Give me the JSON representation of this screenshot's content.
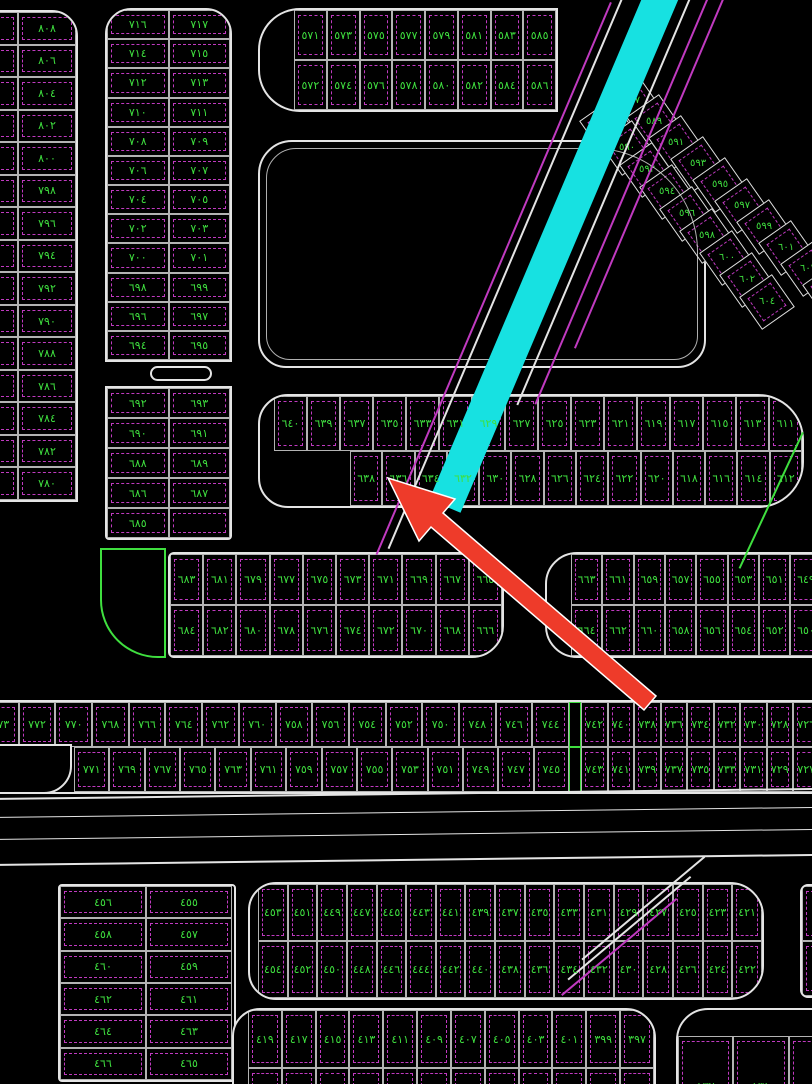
{
  "canvas": {
    "width": 812,
    "height": 1084,
    "background": "#000000"
  },
  "colors": {
    "background": "#000000",
    "road_line_white": "#e4e4e4",
    "plot_dash_magenta": "#c03ac0",
    "number_green": "#3fdf3f",
    "road_cyan": "#17e1e1",
    "arrow_red": "#ee3b2a"
  },
  "labels": {
    "future_text": "مستقبلى"
  },
  "annotation": {
    "type": "red-arrow",
    "points": "388,478 455,499 443,513 656,696 644,710 431,527 419,541",
    "fill": "#ee3b2a",
    "stroke": "#ffffff"
  },
  "diagonal_block": {
    "numbers": [
      "٥٨٧",
      "٥٨٨",
      "٥٨٩",
      "٥٩٠",
      "٥٩١",
      "٥٩٢",
      "٥٩٣",
      "٥٩٤",
      "٥٩٥",
      "٥٩٦",
      "٥٩٧",
      "٥٩٨",
      "٥٩٩",
      "٦٠٠",
      "٦٠١",
      "٦٠٢",
      "٦٠٣",
      "٦٠٤",
      "٦٠٦"
    ],
    "upper_start": [
      632,
      101
    ],
    "upper_step": [
      22,
      21
    ],
    "lower_start": [
      607,
      126
    ],
    "lower_step": [
      20,
      22
    ],
    "rotate": 55,
    "cell": 40
  },
  "blocks": [
    {
      "name": "block-top-left-outer",
      "x": -40,
      "y": 10,
      "w": 118,
      "h": 492,
      "radius": "0 26px 0 0",
      "colWidths": [
        56,
        58
      ],
      "rows": [
        {
          "cells": [
            "٨٠٩",
            "٨٠٨"
          ]
        },
        {
          "cells": [
            "٨٠٧",
            "٨٠٦"
          ]
        },
        {
          "cells": [
            "٨٠٥",
            "٨٠٤"
          ]
        },
        {
          "cells": [
            "٨٠٣",
            "٨٠٢"
          ]
        },
        {
          "cells": [
            "٨٠١",
            "٨٠٠"
          ]
        },
        {
          "cells": [
            "٧٩٩",
            "٧٩٨"
          ]
        },
        {
          "cells": [
            "٧٩٧",
            "٧٩٦"
          ]
        },
        {
          "cells": [
            "٧٩٥",
            "٧٩٤"
          ]
        },
        {
          "cells": [
            "٧٩٣",
            "٧٩٢"
          ]
        },
        {
          "cells": [
            "٧٩١",
            "٧٩٠"
          ]
        },
        {
          "cells": [
            "٧٨٩",
            "٧٨٨"
          ]
        },
        {
          "cells": [
            "٧٨٧",
            "٧٨٦"
          ]
        },
        {
          "cells": [
            "٧٨٥",
            "٧٨٤"
          ]
        },
        {
          "cells": [
            "٧٨٣",
            "٧٨٢"
          ]
        },
        {
          "cells": [
            "٧٨١",
            "٧٨٠"
          ]
        }
      ]
    },
    {
      "name": "block-left-inner-upper",
      "x": 105,
      "y": 8,
      "w": 127,
      "h": 354,
      "radius": "26px 26px 0 0",
      "rows": [
        {
          "cells": [
            "٧١٦",
            "٧١٧"
          ]
        },
        {
          "cells": [
            "٧١٤",
            "٧١٥"
          ]
        },
        {
          "cells": [
            "٧١٢",
            "٧١٣"
          ]
        },
        {
          "cells": [
            "٧١٠",
            "٧١١"
          ]
        },
        {
          "cells": [
            "٧٠٨",
            "٧٠٩"
          ]
        },
        {
          "cells": [
            "٧٠٦",
            "٧٠٧"
          ]
        },
        {
          "cells": [
            "٧٠٤",
            "٧٠٥"
          ]
        },
        {
          "cells": [
            "٧٠٢",
            "٧٠٣"
          ]
        },
        {
          "cells": [
            "٧٠٠",
            "٧٠١"
          ]
        },
        {
          "cells": [
            "٦٩٨",
            "٦٩٩"
          ]
        },
        {
          "cells": [
            "٦٩٦",
            "٦٩٧"
          ]
        },
        {
          "cells": [
            "٦٩٤",
            "٦٩٥"
          ]
        }
      ]
    },
    {
      "name": "block-left-inner-lower",
      "x": 105,
      "y": 386,
      "w": 127,
      "h": 154,
      "radius": "0 0 4px 4px",
      "rows": [
        {
          "cells": [
            "٦٩٢",
            "٦٩٣"
          ]
        },
        {
          "cells": [
            "٦٩٠",
            "٦٩١"
          ]
        },
        {
          "cells": [
            "٦٨٨",
            "٦٨٩"
          ]
        },
        {
          "cells": [
            "٦٨٦",
            "٦٨٧"
          ]
        },
        {
          "cells": [
            "٦٨٥",
            ""
          ]
        }
      ]
    },
    {
      "name": "block-top-middle",
      "x": 258,
      "y": 8,
      "w": 300,
      "h": 104,
      "radius": "42px 0 0 42px",
      "rows": [
        {
          "offset": 34,
          "cells": [
            "٥٧١",
            "٥٧٣",
            "٥٧٥",
            "٥٧٧",
            "٥٧٩",
            "٥٨١",
            "٥٨٣",
            "٥٨٥"
          ]
        },
        {
          "offset": 34,
          "cells": [
            "٥٧٢",
            "٥٧٤",
            "٥٧٦",
            "٥٧٨",
            "٥٨٠",
            "٥٨٢",
            "٥٨٤",
            "٥٨٦"
          ]
        }
      ]
    },
    {
      "name": "block-future-area",
      "x": 258,
      "y": 140,
      "w": 448,
      "h": 228,
      "radius": "34px 110px 28px 28px",
      "rows": []
    },
    {
      "name": "block-mid-rows",
      "x": 258,
      "y": 394,
      "w": 546,
      "h": 114,
      "radius": "30px 46px 46px 30px",
      "rows": [
        {
          "offset": 14,
          "cells": [
            "٦٤٠",
            "٦٣٩",
            "٦٣٧",
            "٦٣٥",
            "٦٣٣",
            "٦٣١",
            "٦٢٩",
            "٦٢٧",
            "٦٢٥",
            "٦٢٣",
            "٦٢١",
            "٦١٩",
            "٦١٧",
            "٦١٥",
            "٦١٣",
            "٦١١"
          ]
        },
        {
          "offset": 90,
          "cells": [
            "٦٣٨",
            "٦٣٦",
            "٦٣٤",
            "٦٣٢",
            "٦٣٠",
            "٦٢٨",
            "٦٢٦",
            "٦٢٤",
            "٦٢٢",
            "٦٢٠",
            "٦١٨",
            "٦١٦",
            "٦١٤",
            "٦١٢"
          ]
        }
      ]
    },
    {
      "name": "block-mid-left",
      "x": 168,
      "y": 552,
      "w": 336,
      "h": 106,
      "radius": "6px 32px 32px 6px",
      "rows": [
        {
          "cells": [
            "٦٨٣",
            "٦٨١",
            "٦٧٩",
            "٦٧٧",
            "٦٧٥",
            "٦٧٣",
            "٦٧١",
            "٦٦٩",
            "٦٦٧",
            "٦٦٥"
          ]
        },
        {
          "cells": [
            "٦٨٤",
            "٦٨٢",
            "٦٨٠",
            "٦٧٨",
            "٦٧٦",
            "٦٧٤",
            "٦٧٢",
            "٦٧٠",
            "٦٦٨",
            "٦٦٦"
          ]
        }
      ]
    },
    {
      "name": "block-mid-right",
      "x": 545,
      "y": 552,
      "w": 310,
      "h": 106,
      "radius": "32px 0 0 32px",
      "rows": [
        {
          "offset": 24,
          "cells": [
            "٦٦٣",
            "٦٦١",
            "٦٥٩",
            "٦٥٧",
            "٦٥٥",
            "٦٥٣",
            "٦٥١",
            "٦٤٩",
            "٦٤٧"
          ]
        },
        {
          "offset": 24,
          "cells": [
            "٦٦٤",
            "٦٦٢",
            "٦٦٠",
            "٦٥٨",
            "٦٥٦",
            "٦٥٤",
            "٦٥٢",
            "٦٥٠",
            "٦٤٨"
          ]
        }
      ]
    },
    {
      "name": "block-band-700s",
      "x": -24,
      "y": 700,
      "w": 872,
      "h": 94,
      "radius": "0",
      "dividerAfter": 26.5,
      "rows": [
        {
          "offset": 4,
          "cells": [
            "٧٧٣",
            "٧٧٢",
            "٧٧٠",
            "٧٦٨",
            "٧٦٦",
            "٧٦٤",
            "٧٦٢",
            "٧٦٠",
            "٧٥٨",
            "٧٥٦",
            "٧٥٤",
            "٧٥٢",
            "٧٥٠",
            "٧٤٨",
            "٧٤٦",
            "٧٤٤",
            "|",
            "٧٤٢",
            "٧٤٠",
            "٧٣٨",
            "٧٣٦",
            "٧٣٤",
            "٧٣٢",
            "٧٣٠",
            "٧٢٨",
            "٧٢٦",
            "٧٢٤"
          ]
        },
        {
          "offset": 96,
          "cells": [
            "٧٧١",
            "٧٦٩",
            "٧٦٧",
            "٧٦٥",
            "٧٦٣",
            "٧٦١",
            "٧٥٩",
            "٧٥٧",
            "٧٥٥",
            "٧٥٣",
            "٧٥١",
            "٧٤٩",
            "٧٤٧",
            "٧٤٥",
            "|",
            "٧٤٣",
            "٧٤١",
            "٧٣٩",
            "٧٣٧",
            "٧٣٥",
            "٧٣٣",
            "٧٣١",
            "٧٢٩",
            "٧٢٧",
            "٧٢٥"
          ]
        }
      ]
    },
    {
      "name": "block-bottom-left",
      "x": 58,
      "y": 884,
      "w": 178,
      "h": 198,
      "radius": "4px",
      "colWidths": [
        86,
        86
      ],
      "rows": [
        {
          "cells": [
            "٤٥٦",
            "٤٥٥"
          ]
        },
        {
          "cells": [
            "٤٥٨",
            "٤٥٧"
          ]
        },
        {
          "cells": [
            "٤٦٠",
            "٤٥٩"
          ]
        },
        {
          "cells": [
            "٤٦٢",
            "٤٦١"
          ]
        },
        {
          "cells": [
            "٤٦٤",
            "٤٦٣"
          ]
        },
        {
          "cells": [
            "٤٦٦",
            "٤٦٥"
          ]
        }
      ]
    },
    {
      "name": "block-bottom-band",
      "x": 248,
      "y": 882,
      "w": 516,
      "h": 118,
      "radius": "28px 34px 34px 28px",
      "rows": [
        {
          "offset": 8,
          "cells": [
            "٤٥٣",
            "٤٥١",
            "٤٤٩",
            "٤٤٧",
            "٤٤٥",
            "٤٤٣",
            "٤٤١",
            "٤٣٩",
            "٤٣٧",
            "٤٣٥",
            "٤٣٣",
            "٤٣١",
            "٤٢٩",
            "٤٢٧",
            "٤٢٥",
            "٤٢٣",
            "٤٢١"
          ]
        },
        {
          "offset": 8,
          "cells": [
            "٤٥٤",
            "٤٥٢",
            "٤٥٠",
            "٤٤٨",
            "٤٤٦",
            "٤٤٤",
            "٤٤٢",
            "٤٤٠",
            "٤٣٨",
            "٤٣٦",
            "٤٣٤",
            "٤٣٢",
            "٤٣٠",
            "٤٢٨",
            "٤٢٦",
            "٤٢٤",
            "٤٢٢"
          ]
        }
      ]
    },
    {
      "name": "block-bottom-300s",
      "x": 232,
      "y": 1008,
      "w": 424,
      "h": 130,
      "radius": "28px 30px 0 0",
      "rows": [
        {
          "offset": 14,
          "h": 58,
          "cells": [
            "٤١٩",
            "٤١٧",
            "٤١٥",
            "٤١٣",
            "٤١١",
            "٤٠٩",
            "٤٠٧",
            "٤٠٥",
            "٤٠٣",
            "٤٠١",
            "٣٩٩",
            "٣٩٧"
          ]
        },
        {
          "offset": 14,
          "cells": [
            "",
            "",
            "",
            "",
            "",
            "",
            "",
            "",
            "",
            "",
            "",
            ""
          ]
        }
      ]
    },
    {
      "name": "block-bottom-right-100s",
      "x": 676,
      "y": 1008,
      "w": 170,
      "h": 130,
      "radius": "32px 36px 0 0",
      "padTop": 26,
      "rows": [
        {
          "cells": [
            "١٣٢",
            "١٣١",
            ""
          ]
        }
      ]
    },
    {
      "name": "block-right-partial",
      "x": 800,
      "y": 884,
      "w": 80,
      "h": 114,
      "radius": "8px 0 0 8px",
      "rows": [
        {
          "cells": [
            ""
          ]
        },
        {
          "cells": [
            ""
          ]
        }
      ]
    }
  ],
  "shapes": [
    {
      "name": "street-median-bar",
      "x": 150,
      "y": 366,
      "w": 62,
      "h": 15,
      "radius": "8px",
      "style": "white"
    },
    {
      "name": "corner-plot-green",
      "x": 100,
      "y": 548,
      "w": 66,
      "h": 110,
      "radius": "0 0 0 58px",
      "style": "green"
    },
    {
      "name": "corner-plot-l",
      "x": -24,
      "y": 744,
      "w": 96,
      "h": 50,
      "radius": "0 0 28px 0",
      "style": "white"
    },
    {
      "name": "road-inner-edge",
      "x": 266,
      "y": 148,
      "w": 432,
      "h": 212,
      "radius": "30px 104px 24px 24px",
      "style": "thin"
    }
  ],
  "road_lines": [
    {
      "name": "cyan-highlight-road",
      "x": 648,
      "y": -16,
      "len": 560,
      "w": 34,
      "rot": 23,
      "color": "road_cyan"
    },
    {
      "name": "road-edge-magenta-1",
      "x": 610,
      "y": 2,
      "len": 600,
      "w": 2,
      "rot": 23,
      "color": "plot_dash_magenta"
    },
    {
      "name": "road-edge-white-1",
      "x": 622,
      "y": -4,
      "len": 600,
      "w": 2,
      "rot": 23,
      "color": "road_line_white"
    },
    {
      "name": "road-edge-white-2",
      "x": 700,
      "y": -28,
      "len": 470,
      "w": 2,
      "rot": 23,
      "color": "road_line_white"
    },
    {
      "name": "road-edge-magenta-2",
      "x": 722,
      "y": -38,
      "len": 480,
      "w": 2,
      "rot": 23,
      "color": "plot_dash_magenta"
    },
    {
      "name": "road-edge-magenta-3",
      "x": 742,
      "y": -48,
      "len": 430,
      "w": 2,
      "rot": 23,
      "color": "plot_dash_magenta"
    },
    {
      "name": "green-boundary-line",
      "x": 802,
      "y": 432,
      "len": 150,
      "w": 2,
      "rot": 25,
      "color": "number_green"
    },
    {
      "name": "road-edge-white-3",
      "x": 704,
      "y": 856,
      "len": 160,
      "w": 2,
      "rot": 50,
      "color": "road_line_white"
    },
    {
      "name": "road-edge-white-4",
      "x": 690,
      "y": 876,
      "len": 160,
      "w": 2,
      "rot": 50,
      "color": "road_line_white"
    },
    {
      "name": "road-edge-magenta-4",
      "x": 676,
      "y": 898,
      "len": 150,
      "w": 2,
      "rot": 50,
      "color": "plot_dash_magenta"
    }
  ],
  "highway_lines": [
    {
      "name": "highway-edge-top",
      "y": 798,
      "t": 2
    },
    {
      "name": "highway-lane-1",
      "y": 817,
      "t": 1
    },
    {
      "name": "highway-lane-2",
      "y": 839,
      "t": 1
    },
    {
      "name": "highway-edge-bottom",
      "y": 864,
      "t": 2
    }
  ]
}
